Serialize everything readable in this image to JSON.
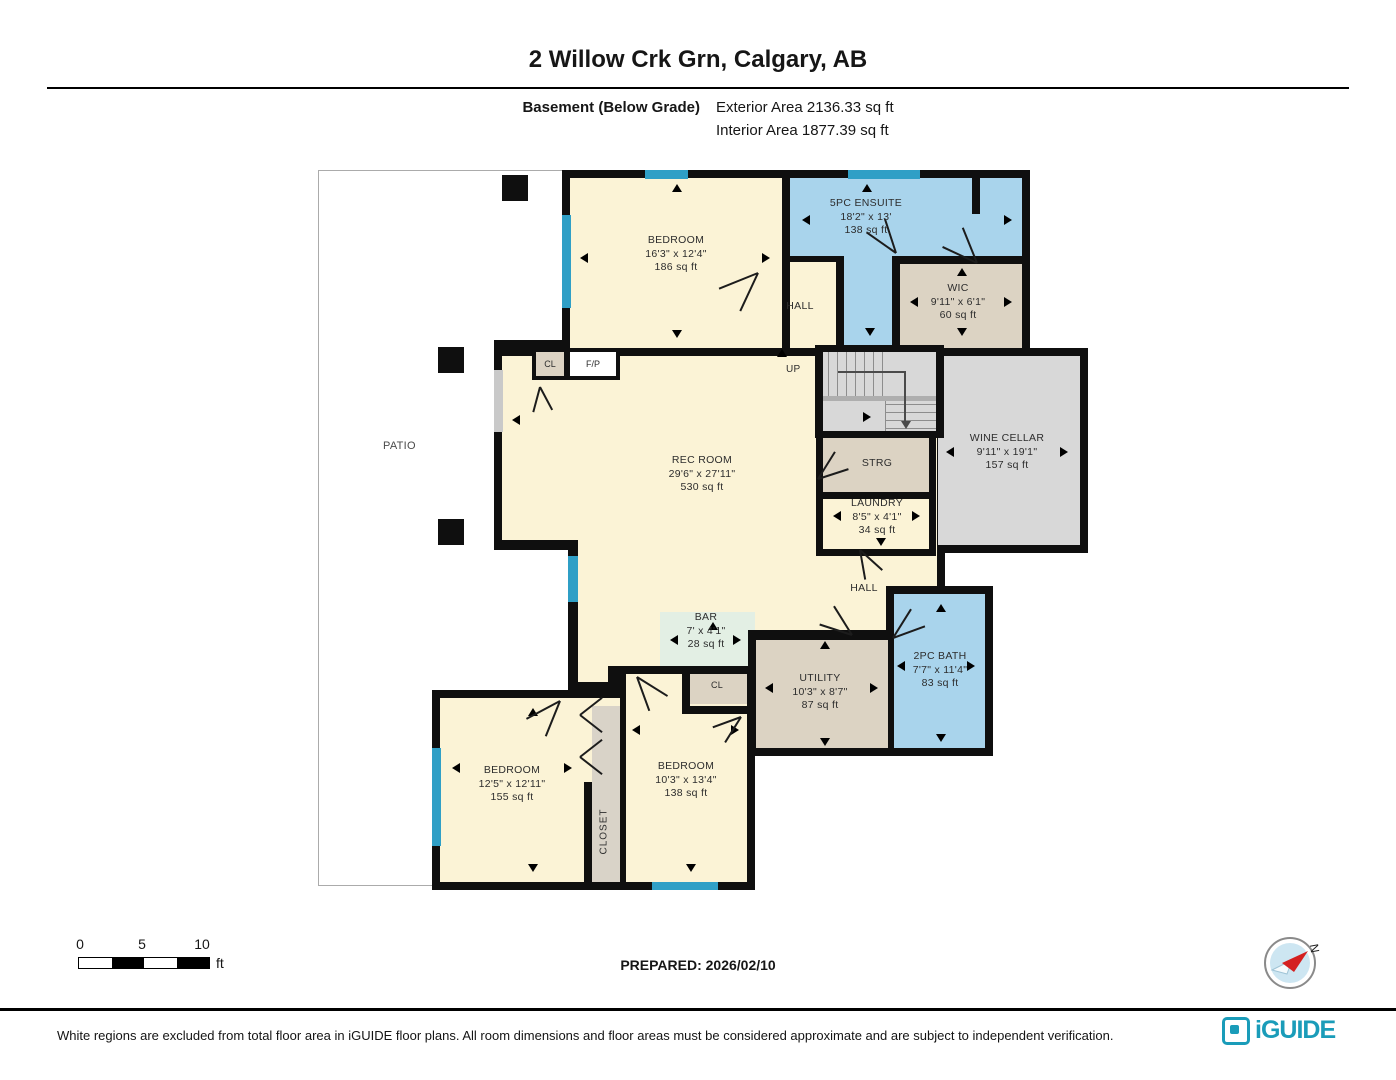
{
  "header": {
    "title": "2 Willow Crk Grn, Calgary, AB",
    "floor_label": "Basement (Below Grade)",
    "exterior_area": "Exterior Area 2136.33 sq ft",
    "interior_area": "Interior Area 1877.39 sq ft"
  },
  "plan": {
    "rooms": {
      "bedroom_top": {
        "name": "BEDROOM",
        "dims": "16'3\" x 12'4\"",
        "area": "186 sq ft"
      },
      "ensuite": {
        "name": "5PC ENSUITE",
        "dims": "18'2\" x 13'",
        "area": "138 sq ft"
      },
      "wic": {
        "name": "WIC",
        "dims": "9'11\" x 6'1\"",
        "area": "60 sq ft"
      },
      "hall_top": {
        "name": "HALL"
      },
      "up": {
        "name": "UP"
      },
      "rec_room": {
        "name": "REC ROOM",
        "dims": "29'6\" x 27'11\"",
        "area": "530 sq ft"
      },
      "wine_cellar": {
        "name": "WINE CELLAR",
        "dims": "9'11\" x 19'1\"",
        "area": "157 sq ft"
      },
      "strg": {
        "name": "STRG"
      },
      "laundry": {
        "name": "LAUNDRY",
        "dims": "8'5\" x 4'1\"",
        "area": "34 sq ft"
      },
      "hall_bottom": {
        "name": "HALL"
      },
      "bar": {
        "name": "BAR",
        "dims": "7' x 4'1\"",
        "area": "28 sq ft"
      },
      "utility": {
        "name": "UTILITY",
        "dims": "10'3\" x 8'7\"",
        "area": "87 sq ft"
      },
      "bath": {
        "name": "2PC BATH",
        "dims": "7'7\" x 11'4\"",
        "area": "83 sq ft"
      },
      "bedroom_bl": {
        "name": "BEDROOM",
        "dims": "12'5\" x 12'11\"",
        "area": "155 sq ft"
      },
      "bedroom_br": {
        "name": "BEDROOM",
        "dims": "10'3\" x 13'4\"",
        "area": "138 sq ft"
      },
      "closet": {
        "name": "CLOSET"
      },
      "cl_rec": {
        "name": "CL"
      },
      "fp": {
        "name": "F/P"
      },
      "cl_bedroom": {
        "name": "CL"
      },
      "patio": {
        "name": "PATIO"
      }
    }
  },
  "scale_bar": {
    "tick0": "0",
    "tick1": "5",
    "tick2": "10",
    "unit": "ft"
  },
  "compass": {
    "label": "N"
  },
  "footer": {
    "prepared": "PREPARED: 2026/02/10",
    "disclaimer": "White regions are excluded from total floor area in iGUIDE floor plans. All room dimensions and floor areas must be considered approximate and are subject to independent verification.",
    "brand": "iGUIDE"
  },
  "colors": {
    "wall": "#0f0f0f",
    "room_cream": "#fbf3d6",
    "room_blue": "#a9d4ec",
    "room_tan": "#dcd3c3",
    "room_gray": "#d8d8d8",
    "room_mint": "#e3efe4",
    "window_blue": "#2f9fc6",
    "brand_teal": "#1a9cb9",
    "compass_red": "#d42020"
  }
}
